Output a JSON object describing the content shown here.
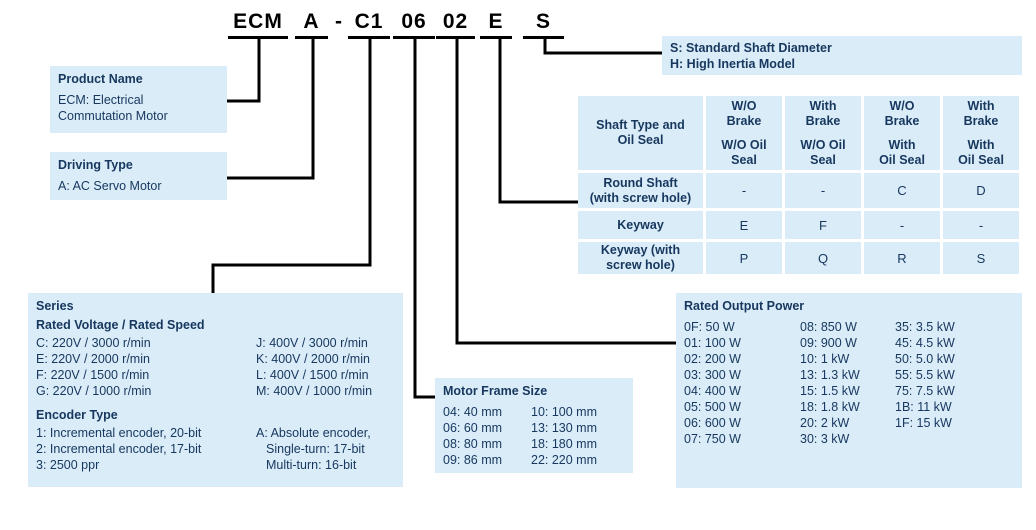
{
  "colors": {
    "box_fill": "#d9ecf8",
    "text_navy": "#17375e",
    "line_black": "#000000"
  },
  "title": {
    "segments": [
      "ECM",
      "A",
      "-",
      "C1",
      "06",
      "02",
      "E",
      "S"
    ]
  },
  "boxes": {
    "product_name": {
      "title": "Product Name",
      "lines": [
        "ECM: Electrical",
        "Commutation Motor"
      ]
    },
    "driving_type": {
      "title": "Driving Type",
      "lines": [
        "A: AC Servo Motor"
      ]
    },
    "series": {
      "title": "Series",
      "voltage_title": "Rated Voltage /  Rated Speed",
      "voltage_left": [
        "C: 220V / 3000 r/min",
        "E: 220V / 2000 r/min",
        "F: 220V / 1500 r/min",
        "G: 220V / 1000 r/min"
      ],
      "voltage_right": [
        "J: 400V / 3000 r/min",
        "K: 400V / 2000 r/min",
        "L: 400V / 1500 r/min",
        "M: 400V / 1000 r/min"
      ],
      "encoder_title": "Encoder Type",
      "encoder_left": [
        "1: Incremental encoder, 20-bit",
        "2: Incremental encoder, 17-bit",
        "3: 2500 ppr"
      ],
      "encoder_right": [
        "A: Absolute encoder,",
        "Single-turn: 17-bit",
        "Multi-turn: 16-bit"
      ]
    },
    "motor_frame": {
      "title": "Motor Frame Size",
      "left": [
        "04: 40 mm",
        "06: 60 mm",
        "08: 80 mm",
        "09: 86 mm"
      ],
      "right": [
        "10: 100 mm",
        "13: 130 mm",
        "18: 180 mm",
        "22: 220 mm"
      ]
    },
    "rated_power": {
      "title": "Rated Output Power",
      "col1": [
        "0F: 50 W",
        "01: 100 W",
        "02: 200 W",
        "03: 300 W",
        "04: 400 W",
        "05: 500 W",
        "06: 600 W",
        "07: 750 W"
      ],
      "col2": [
        "08: 850 W",
        "09: 900 W",
        "10: 1 kW",
        "13: 1.3 kW",
        "15: 1.5 kW",
        "18: 1.8 kW",
        "20: 2 kW",
        "30: 3 kW"
      ],
      "col3": [
        "35: 3.5 kW",
        "45: 4.5 kW",
        "50: 5.0 kW",
        "55: 5.5 kW",
        "75: 7.5 kW",
        "1B: 11 kW",
        "1F: 15 kW"
      ]
    },
    "shaft_suffix": {
      "lines": [
        "S: Standard Shaft Diameter",
        "H: High Inertia Model"
      ]
    }
  },
  "shaft_table": {
    "corner": "Shaft Type and\nOil Seal",
    "headers": [
      {
        "top": "W/O\nBrake",
        "bottom": "W/O Oil\nSeal"
      },
      {
        "top": "With\nBrake",
        "bottom": "W/O Oil\nSeal"
      },
      {
        "top": "W/O\nBrake",
        "bottom": "With\nOil Seal"
      },
      {
        "top": "With\nBrake",
        "bottom": "With\nOil Seal"
      }
    ],
    "rows": [
      {
        "label": "Round Shaft\n(with screw hole)",
        "values": [
          "-",
          "-",
          "C",
          "D"
        ]
      },
      {
        "label": "Keyway",
        "values": [
          "E",
          "F",
          "-",
          "-"
        ]
      },
      {
        "label": "Keyway (with\nscrew hole)",
        "values": [
          "P",
          "Q",
          "R",
          "S"
        ]
      }
    ]
  }
}
